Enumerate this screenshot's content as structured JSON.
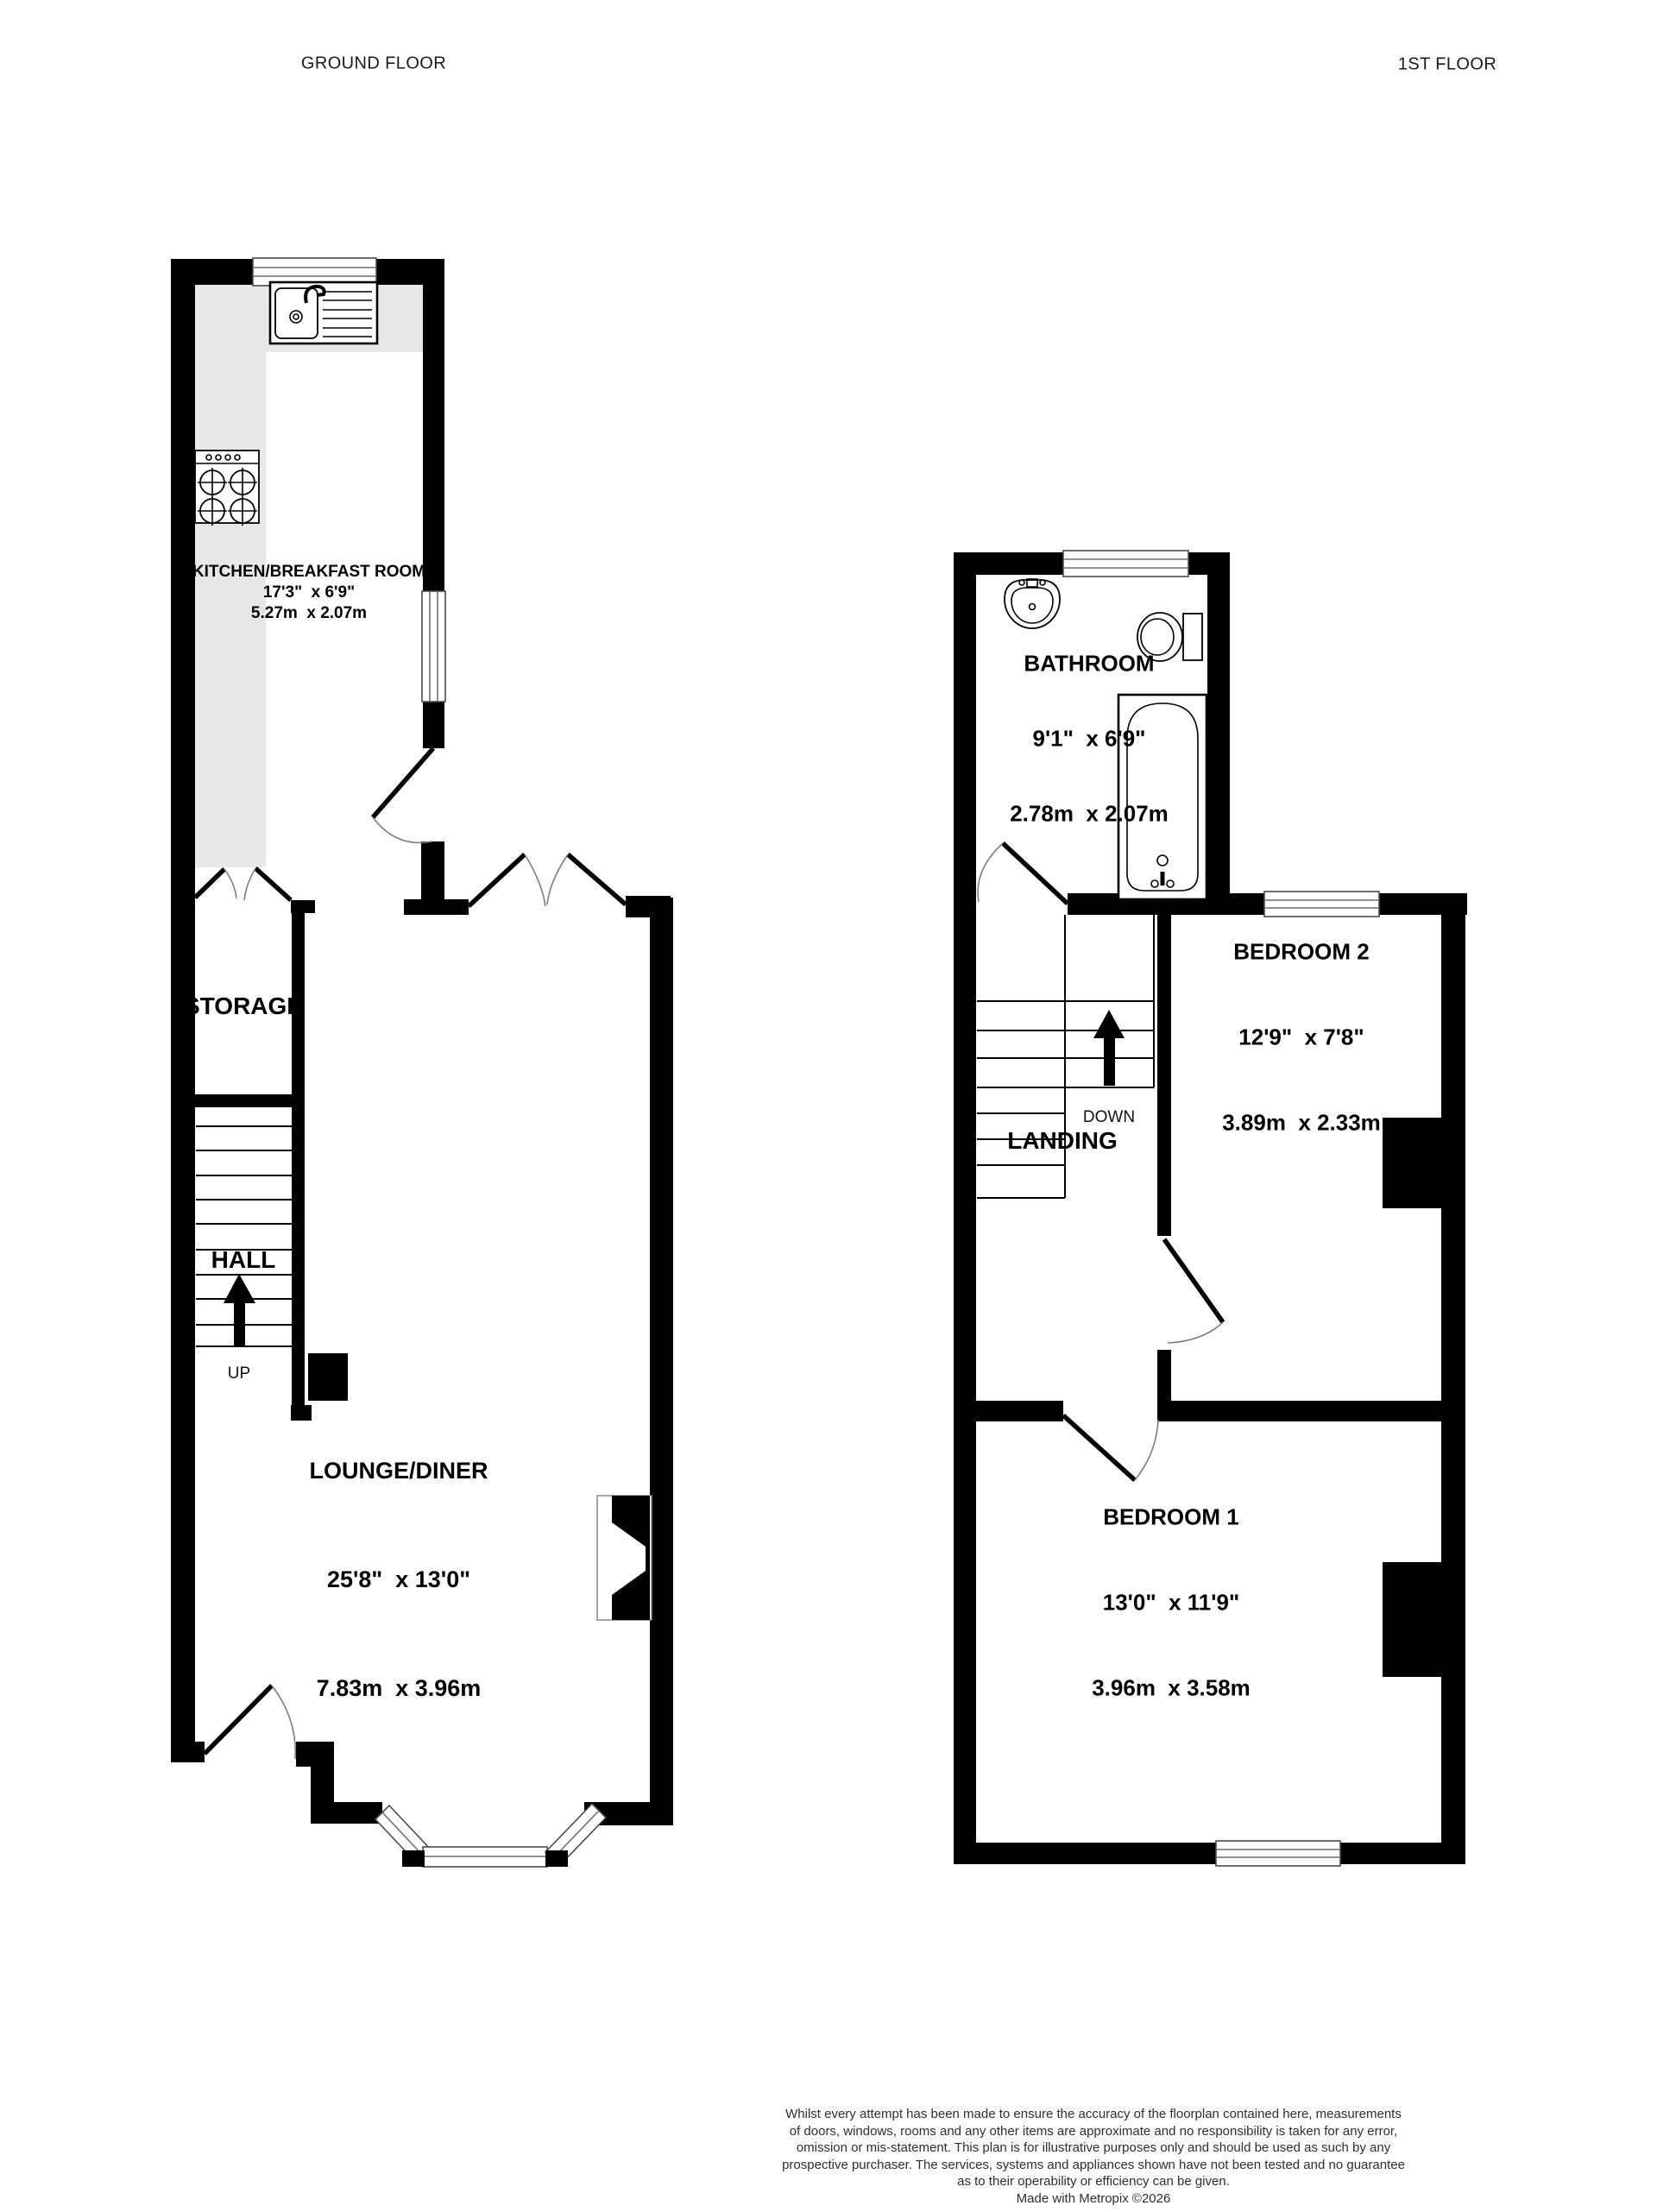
{
  "titles": {
    "ground_floor": "GROUND FLOOR",
    "first_floor": "1ST FLOOR"
  },
  "ground_floor": {
    "kitchen": {
      "name": "KITCHEN/BREAKFAST ROOM",
      "imperial": "17'3\"  x 6'9\"",
      "metric": "5.27m  x 2.07m"
    },
    "storage": {
      "name": "STORAGE"
    },
    "hall": {
      "name": "HALL",
      "direction": "UP"
    },
    "lounge": {
      "name": "LOUNGE/DINER",
      "imperial": "25'8\"  x 13'0\"",
      "metric": "7.83m  x 3.96m"
    }
  },
  "first_floor": {
    "bathroom": {
      "name": "BATHROOM",
      "imperial": "9'1\"  x 6'9\"",
      "metric": "2.78m  x 2.07m"
    },
    "bedroom2": {
      "name": "BEDROOM 2",
      "imperial": "12'9\"  x 7'8\"",
      "metric": "3.89m  x 2.33m"
    },
    "landing": {
      "name": "LANDING",
      "direction": "DOWN"
    },
    "bedroom1": {
      "name": "BEDROOM 1",
      "imperial": "13'0\"  x 11'9\"",
      "metric": "3.96m  x 3.58m"
    }
  },
  "footer": {
    "lines": [
      "Whilst every attempt has been made to ensure the accuracy of the floorplan contained here, measurements",
      "of doors, windows, rooms and any other items are approximate and no responsibility is taken for any error,",
      "omission or mis-statement. This plan is for illustrative purposes only and should be used as such by any",
      "prospective purchaser. The services, systems and appliances shown have not been tested and no guarantee",
      "as to their operability or efficiency can be given."
    ],
    "credit": "Made with Metropix ©2026"
  },
  "colors": {
    "wall": "#000000",
    "counter": "#e8e8e8",
    "arc": "#7d7d7d"
  }
}
